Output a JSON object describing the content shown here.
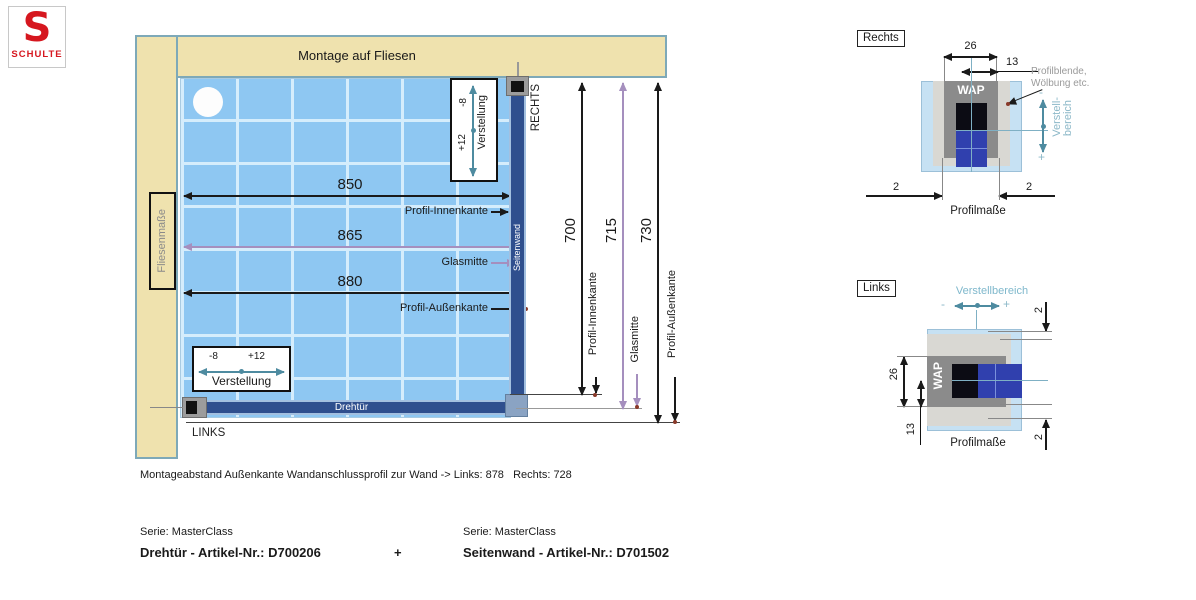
{
  "logo": {
    "letter": "S",
    "brand": "SCHULTE"
  },
  "plan": {
    "wall_label": "Montage auf Fliesen",
    "tile_scale_label": "Fliesenmaße",
    "right_label": "RECHTS",
    "left_label": "LINKS",
    "door_label": "Drehtür",
    "side_wall_label": "Seitenwand",
    "dim_inner": {
      "value": "850",
      "edge_label": "Profil-Innenkante"
    },
    "dim_glass": {
      "value": "865",
      "edge_label": "Glasmitte"
    },
    "dim_outer": {
      "value": "880",
      "edge_label": "Profil-Außenkante"
    },
    "vdim_inner": {
      "value": "700",
      "edge_label": "Profil-Innenkante"
    },
    "vdim_glass": {
      "value": "715",
      "edge_label": "Glasmitte"
    },
    "vdim_outer": {
      "value": "730",
      "edge_label": "Profil-Außenkante"
    },
    "adjust_top": {
      "minus": "-8",
      "plus": "+12",
      "label": "Verstellung"
    },
    "adjust_bottom": {
      "minus": "-8",
      "plus": "+12",
      "label": "Verstellung"
    }
  },
  "detail_right": {
    "title": "Rechts",
    "dim_width": "26",
    "dim_half": "13",
    "profile_label": "WAP",
    "note_line1": "Profilblende,",
    "note_line2": "Wölbung etc.",
    "adjust_line1": "Verstell-",
    "adjust_line2": "bereich",
    "minus": "-",
    "plus": "+",
    "gap_left": "2",
    "gap_right": "2",
    "caption": "Profilmaße"
  },
  "detail_left": {
    "title": "Links",
    "adjust_label": "Verstellbereich",
    "minus": "-",
    "plus": "+",
    "profile_label": "WAP",
    "dim_width": "26",
    "dim_half": "13",
    "gap_top": "2",
    "gap_bottom": "2",
    "caption": "Profilmaße"
  },
  "footer": {
    "mount_note": "Montageabstand Außenkante Wandanschlussprofil zur Wand -> Links: 878   Rechts: 728",
    "series_left": "Serie: MasterClass",
    "article_left": "Drehtür - Artikel-Nr.: D700206",
    "plus": "+",
    "series_right": "Serie: MasterClass",
    "article_right": "Seitenwand - Artikel-Nr.: D701502"
  },
  "colors": {
    "brand_red": "#d6171f",
    "wall_beige": "#efe2ae",
    "tile_blue": "#8ec7f2",
    "profile_blue": "#2f4f8e",
    "dim_purple": "#a58fbe",
    "adjust_teal": "#4e8ba0"
  }
}
